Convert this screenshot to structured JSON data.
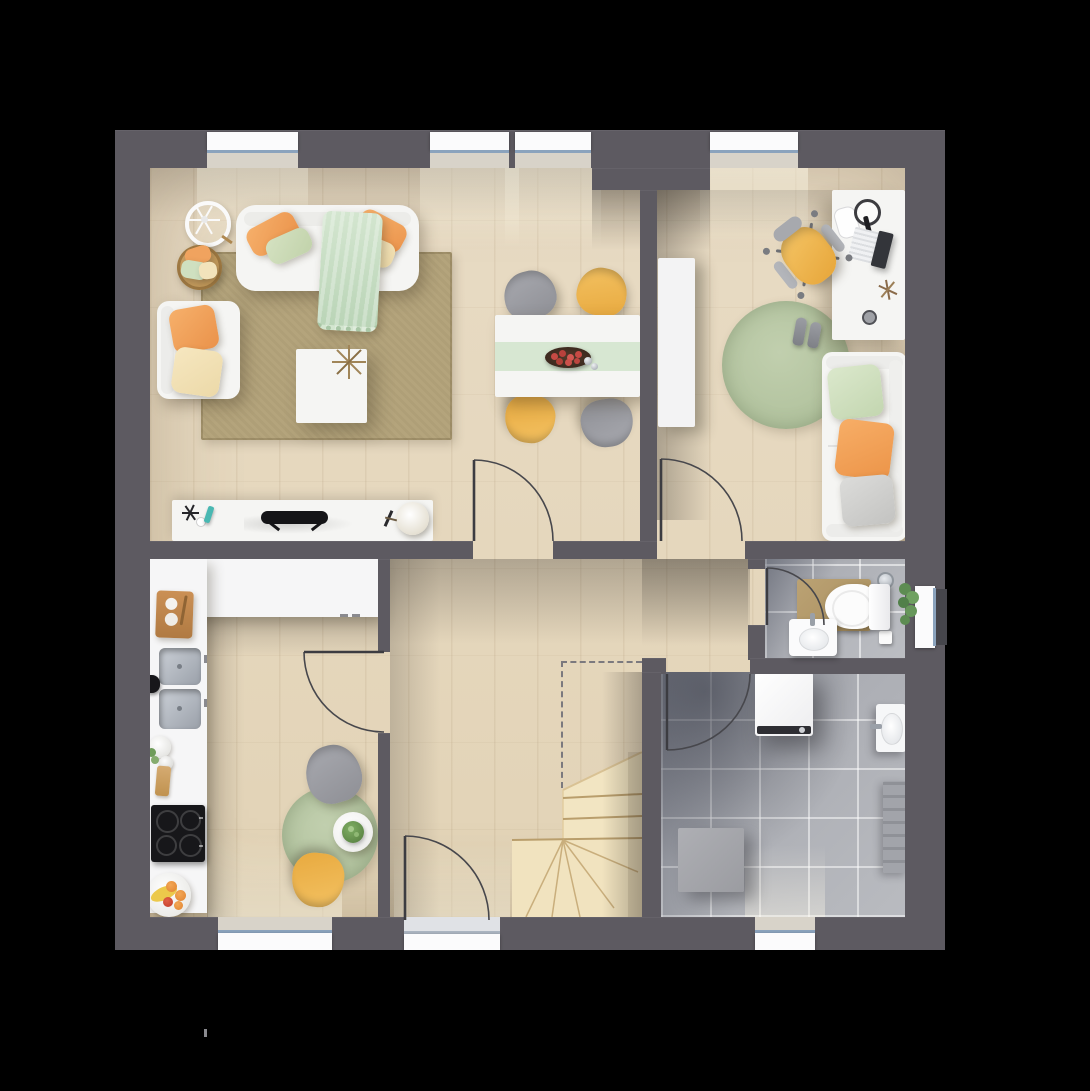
{
  "meta": {
    "title": "floor-plan-ground-floor",
    "view": "top-down-3d-render",
    "canvas": {
      "width": 1090,
      "height": 1091
    },
    "background": "#000000"
  },
  "palette": {
    "wall": "#5d5a61",
    "wood_floor": "#e5d7bf",
    "stairs": "#f2e5c2",
    "tile_gray": "#aeb0b6",
    "rug_tan": "#b4a47c",
    "rug_green": "#b6c7a3",
    "white_furniture": "#f5f5f3",
    "accent_yellow": "#eeb44e",
    "accent_orange": "#f2a35f",
    "accent_mint": "#cfe3cc",
    "accent_cream": "#f2e2bd",
    "window_frame": "#8ba3bd"
  },
  "rooms": {
    "living": {
      "label": "living-room",
      "furniture": [
        "sofa",
        "armchair",
        "coffee-table",
        "tan-rug",
        "tv-console",
        "pillow-basket",
        "wheel-decor",
        "throw-blanket"
      ]
    },
    "dining": {
      "label": "dining-area",
      "furniture": [
        "dining-table",
        "table-runner",
        "fruit-tray",
        "chair-gray",
        "chair-yellow",
        "chair-yellow",
        "chair-gray"
      ]
    },
    "office": {
      "label": "office-guest-room",
      "furniture": [
        "desk",
        "laptop",
        "headphones",
        "office-chair",
        "round-rug",
        "shoes",
        "daybed",
        "tall-cabinet"
      ]
    },
    "kitchen": {
      "label": "kitchen",
      "furniture": [
        "l-shaped-counter",
        "double-sink",
        "cooktop",
        "cutting-board",
        "fruit-plate",
        "bistro-table",
        "chair-gray",
        "chair-yellow",
        "round-rug"
      ]
    },
    "hallway": {
      "label": "hallway",
      "furniture": [
        "winder-staircase",
        "stair-void-dashed-outline"
      ]
    },
    "wc": {
      "label": "wc",
      "furniture": [
        "toilet",
        "hand-basin",
        "bath-mat",
        "plant",
        "floor-drain",
        "waste-bin"
      ]
    },
    "utility": {
      "label": "utility-room",
      "furniture": [
        "washing-machine",
        "wall-basin",
        "radiator",
        "storage-box"
      ]
    }
  },
  "openings": {
    "windows": [
      "living-top",
      "dining-top-left",
      "dining-top-right",
      "office-top",
      "kitchen-bottom",
      "utility-bottom",
      "wc-right"
    ],
    "doors": [
      "front-entrance",
      "living-dining-door",
      "office-door",
      "kitchen-door",
      "wc-door",
      "utility-door"
    ]
  }
}
